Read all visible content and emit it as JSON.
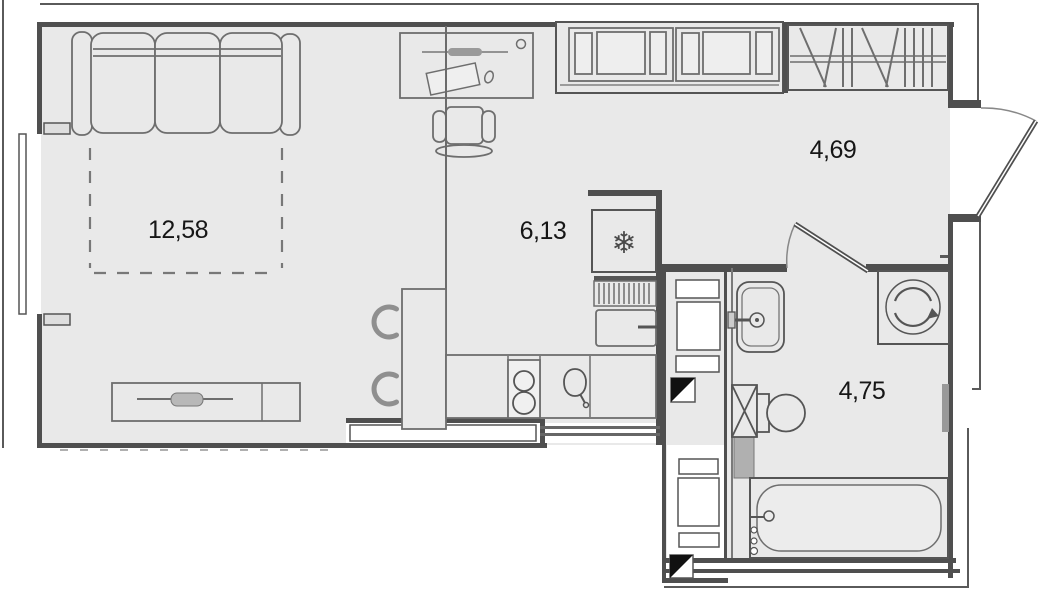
{
  "plan": {
    "type": "studio-apartment-floor-plan",
    "rooms": [
      {
        "name": "living-room",
        "area": "12,58"
      },
      {
        "name": "kitchen",
        "area": "6,13"
      },
      {
        "name": "hallway",
        "area": "4,69"
      },
      {
        "name": "bathroom",
        "area": "4,75"
      }
    ],
    "icons": {
      "freezer": "❄"
    },
    "colors": {
      "floor": "#e9e9e9",
      "wall": "#4f4f4f",
      "furniture_line": "#6e6e6e",
      "exterior": "#ffffff",
      "marker_black": "#111111"
    }
  }
}
